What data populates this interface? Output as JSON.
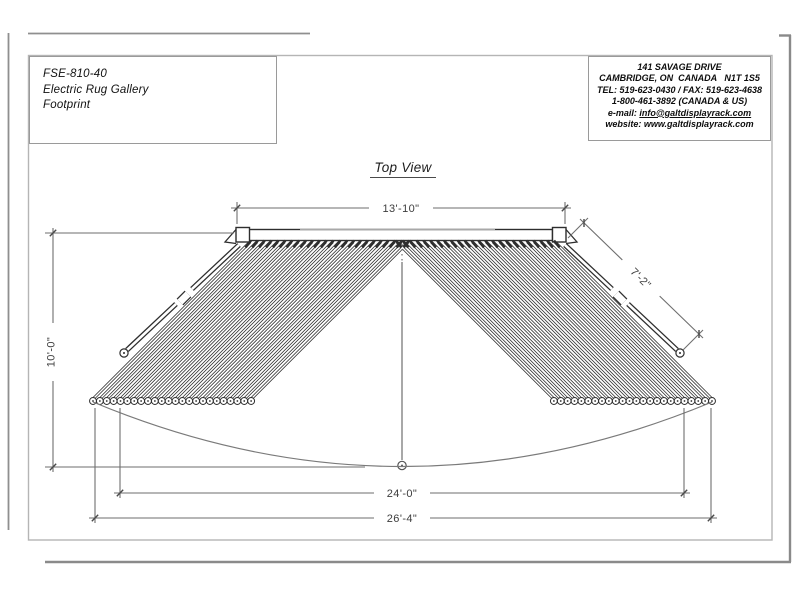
{
  "title_block": {
    "model": "FSE-810-40",
    "product": "Electric Rug Gallery",
    "view": "Footprint"
  },
  "company_block": {
    "line1": "141 SAVAGE DRIVE",
    "line2": "CAMBRIDGE, ON  CANADA   N1T 1S5",
    "line3": "TEL: 519-623-0430 / FAX: 519-623-4638",
    "line4": "1-800-461-3892 (CANADA & US)",
    "email_label": "e-mail: ",
    "email": "info@galtdisplayrack.com",
    "website_label": "website: ",
    "website": "www.galtdisplayrack.com"
  },
  "view_title": "Top View",
  "dimensions": {
    "rail_width": "13'-10\"",
    "end_arm": "7'-2\"",
    "depth": "10'-0\"",
    "span_inner": "24'-0\"",
    "span_outer": "26'-4\""
  },
  "drawing": {
    "arms_per_side": 24,
    "colors": {
      "ink": "#2e2e2e",
      "dim": "#6e6e6e",
      "soft": "#7a7a7a",
      "frame": "#8f8f8f",
      "sheet": "#b5b5b5",
      "box": "#9a9a9a"
    }
  }
}
